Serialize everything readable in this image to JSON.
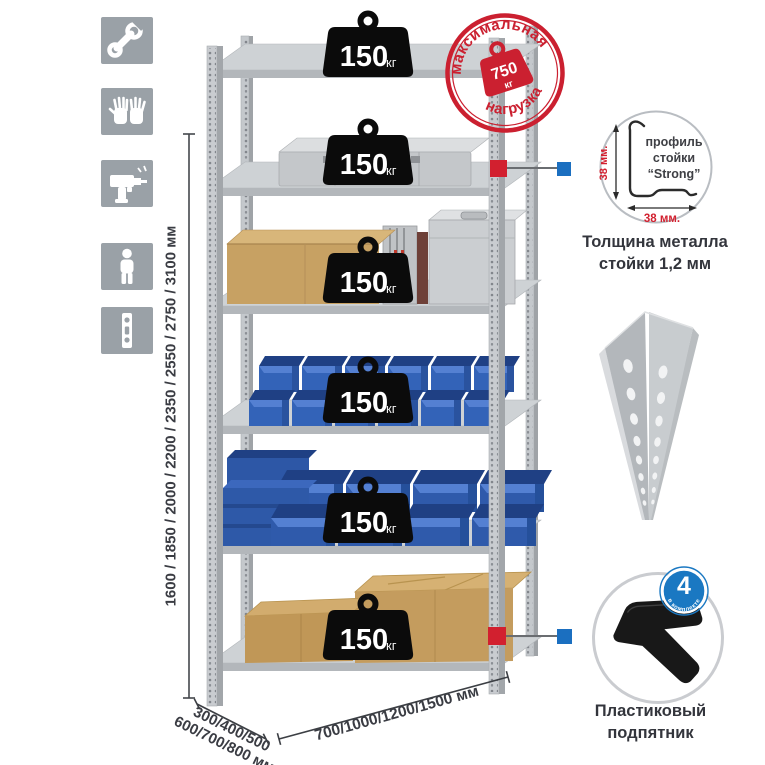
{
  "colors": {
    "accent_red": "#d2202f",
    "accent_blue": "#1b6fc0",
    "stamp_red": "#cb2030",
    "tile_gray": "#9aa1a7",
    "bin_blue": "#3363b8"
  },
  "left_icons": {
    "items": [
      {
        "name": "wrench-icon"
      },
      {
        "name": "gloves-icon"
      },
      {
        "name": "drill-icon"
      },
      {
        "name": "person-icon"
      },
      {
        "name": "post-strip-icon"
      }
    ]
  },
  "height_dimension": {
    "label": "1600 / 1850 / 2000 / 2200 / 2350 / 2550 / 2750 / 3100 мм"
  },
  "depth_dimension": {
    "line1": "300/400/500",
    "line2": "600/700/800 мм"
  },
  "width_dimension": {
    "label": "700/1000/1200/1500 мм"
  },
  "stamp": {
    "arc_top": "максимальная",
    "arc_bottom": "нагрузка",
    "value": "750",
    "unit": "кг"
  },
  "shelves": [
    {
      "load": "150",
      "unit": "кг"
    },
    {
      "load": "150",
      "unit": "кг"
    },
    {
      "load": "150",
      "unit": "кг"
    },
    {
      "load": "150",
      "unit": "кг"
    },
    {
      "load": "150",
      "unit": "кг"
    },
    {
      "load": "150",
      "unit": "кг"
    }
  ],
  "profile_detail": {
    "line1": "профиль",
    "line2": "стойки",
    "line3": "“Strong”",
    "dim_v": "38 мм.",
    "dim_h": "38 мм.",
    "caption1": "Толщина металла",
    "caption2": "стойки 1,2 мм"
  },
  "foot_detail": {
    "badge_value": "4",
    "badge_arc": "в комплекте",
    "caption1": "Пластиковый",
    "caption2": "подпятник"
  }
}
